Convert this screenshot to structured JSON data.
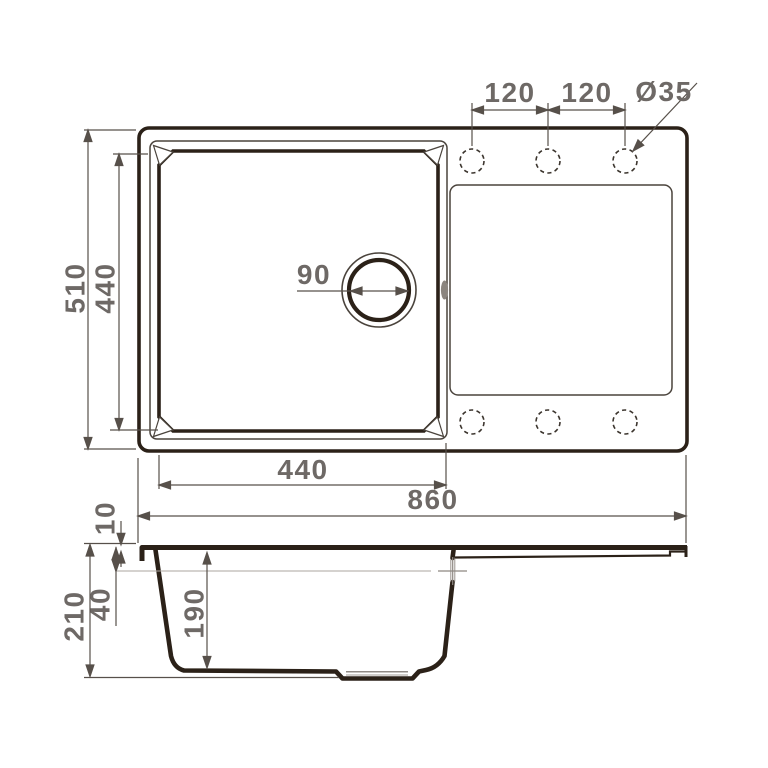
{
  "drawing_title": "Kitchen sink technical drawing — plan view and cross-section",
  "colors": {
    "line_dark": "#2b2118",
    "line_medium": "#4a433c",
    "dimension_line": "#57504a",
    "label_text": "#6e6966",
    "reference_light": "#aba59f",
    "background": "#ffffff"
  },
  "views": {
    "top_view": "plan view with bowl, drain and drainboard",
    "side_view": "cross-section with bowl depth profile"
  },
  "dims": {
    "overall_length": "860",
    "overall_width": "510",
    "bowl_inner_width": "440",
    "bowl_inner_length": "440",
    "drain_diameter": "90",
    "tap_spacing_left": "120",
    "tap_spacing_right": "120",
    "tap_hole_diameter": "Ø35",
    "deck_thickness": "10",
    "overflow_offset": "40",
    "bowl_depth": "190",
    "overall_height": "210"
  }
}
